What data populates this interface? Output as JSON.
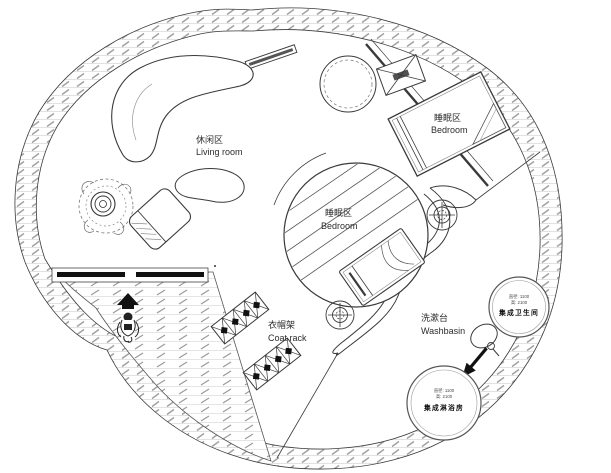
{
  "drawing": {
    "type": "circular-tiny-house-floor-plan"
  },
  "labels": {
    "living_room": {
      "zh": "休闲区",
      "en": "Living room"
    },
    "bedroom_upper": {
      "zh": "睡眠区",
      "en": "Bedroom"
    },
    "bedroom_center": {
      "zh": "睡眠区",
      "en": "Bedroom"
    },
    "coat_rack": {
      "zh": "衣帽架",
      "en": "Coat rack"
    },
    "washbasin": {
      "zh": "洗漱台",
      "en": "Washbasin"
    },
    "bathroom_pod": {
      "spec_diameter": "直径: 1100",
      "spec_height": "高: 2100",
      "name": "集成卫生间"
    },
    "shower_pod": {
      "spec_diameter": "直径: 1100",
      "spec_height": "高: 2100",
      "name": "集成淋浴房"
    }
  },
  "colors": {
    "line": "#3a3a3a",
    "hatch_light": "#cccccc",
    "hatch_dark": "#9a9a9a",
    "solid": "#111111"
  }
}
